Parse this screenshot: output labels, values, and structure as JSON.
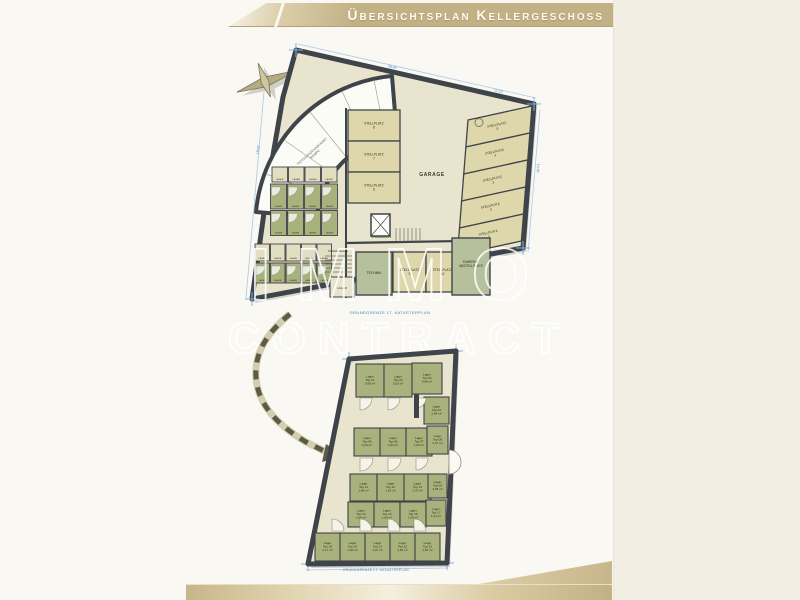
{
  "page": {
    "title": "Übersichtsplan Kellergeschoss",
    "watermark_top": "IMMO",
    "watermark_bottom": "CONTRACT"
  },
  "colors": {
    "banner_gold": "#c2b185",
    "footer_gold": "#c7b68a",
    "wall": "#3f444b",
    "plan_fill": "#e9e4cd",
    "room_green": "#a9b17c",
    "tech_green": "#b7c09c",
    "parking_fill": "#ddd7ab",
    "road_white": "#fcfcf6",
    "dimension_blue": "#3f86c2",
    "label_dark": "#2e3118"
  },
  "big_plan": {
    "garage": "GARAGE",
    "ramp_line1": "TIEFGARAGENABFAHRT",
    "ramp_line2": "RAMPE",
    "stairs1": "STIEGENHAUS",
    "stairs2": "STIEGENHAUS",
    "technik": "TECHNIK",
    "bike_line1": "FAHRRAD",
    "bike_line2": "ABSTELLPLATZ",
    "cellar_room": "LAGER",
    "parking_label": "STELLPLATZ",
    "parking_left": [
      {
        "x": 348,
        "y": 110,
        "w": 52,
        "h": 31,
        "num": "8"
      },
      {
        "x": 348,
        "y": 141,
        "w": 52,
        "h": 31,
        "num": "7"
      },
      {
        "x": 348,
        "y": 172,
        "w": 52,
        "h": 31,
        "num": "6"
      }
    ],
    "parking_right": [
      {
        "num": "5",
        "accessible": true
      },
      {
        "num": "4"
      },
      {
        "num": "3"
      },
      {
        "num": "2"
      },
      {
        "num": "1"
      }
    ],
    "parking_bottom": [
      {
        "x": 393,
        "y": 252,
        "w": 33,
        "h": 40,
        "num": "9"
      },
      {
        "x": 426,
        "y": 252,
        "w": 33,
        "h": 40,
        "num": "10"
      }
    ],
    "cluster_label": "LAGER",
    "cluster_cells": [
      {
        "x": 272,
        "y": 167,
        "w": 15.5,
        "h": 15,
        "f": "c"
      },
      {
        "x": 288.5,
        "y": 167,
        "w": 15.5,
        "h": 15,
        "f": "c"
      },
      {
        "x": 305,
        "y": 167,
        "w": 15.5,
        "h": 15,
        "f": "c"
      },
      {
        "x": 321.5,
        "y": 167,
        "w": 15.5,
        "h": 15,
        "f": "c"
      },
      {
        "x": 270.5,
        "y": 184,
        "w": 16,
        "h": 25,
        "f": "g"
      },
      {
        "x": 287.5,
        "y": 184,
        "w": 16,
        "h": 25,
        "f": "g"
      },
      {
        "x": 304.5,
        "y": 184,
        "w": 16,
        "h": 25,
        "f": "g"
      },
      {
        "x": 321.5,
        "y": 184,
        "w": 16,
        "h": 25,
        "f": "g"
      },
      {
        "x": 270.5,
        "y": 210.5,
        "w": 16,
        "h": 25,
        "f": "g"
      },
      {
        "x": 287.5,
        "y": 210.5,
        "w": 16,
        "h": 25,
        "f": "g"
      },
      {
        "x": 304.5,
        "y": 210.5,
        "w": 16,
        "h": 25,
        "f": "g"
      },
      {
        "x": 321.5,
        "y": 210.5,
        "w": 16,
        "h": 25,
        "f": "g"
      },
      {
        "x": 255,
        "y": 244,
        "w": 14.5,
        "h": 17,
        "f": "c"
      },
      {
        "x": 270.5,
        "y": 244,
        "w": 14.5,
        "h": 17,
        "f": "c"
      },
      {
        "x": 286,
        "y": 244,
        "w": 14.5,
        "h": 17,
        "f": "c"
      },
      {
        "x": 301.5,
        "y": 244,
        "w": 14.5,
        "h": 17,
        "f": "c"
      },
      {
        "x": 317,
        "y": 244,
        "w": 14.5,
        "h": 17,
        "f": "c"
      },
      {
        "x": 255,
        "y": 263,
        "w": 14.5,
        "h": 20,
        "f": "g"
      },
      {
        "x": 270.5,
        "y": 263,
        "w": 14.5,
        "h": 20,
        "f": "g"
      },
      {
        "x": 286,
        "y": 263,
        "w": 14.5,
        "h": 20,
        "f": "g"
      },
      {
        "x": 301.5,
        "y": 263,
        "w": 14.5,
        "h": 20,
        "f": "g"
      },
      {
        "x": 317,
        "y": 263,
        "w": 14.5,
        "h": 20,
        "f": "g"
      }
    ],
    "boundary_text": "GRUNDGRENZE LT. KATASTERPLAN",
    "dim_top_a": "28,45",
    "dim_top_b": "12,10",
    "dim_right": "14,30",
    "dim_left": "19,62"
  },
  "small_plan": {
    "room_label": "Lager",
    "rooms": [
      {
        "x": 356,
        "y": 364,
        "w": 28,
        "h": 33,
        "top": "Top 01",
        "area": "3,99 m²"
      },
      {
        "x": 384,
        "y": 364,
        "w": 28,
        "h": 33,
        "top": "Top 02",
        "area": "3,53 m²"
      },
      {
        "x": 412,
        "y": 363,
        "w": 30,
        "h": 31,
        "top": "Top 03",
        "area": "3,99 m²"
      },
      {
        "x": 424,
        "y": 397,
        "w": 25,
        "h": 27,
        "top": "Top 04",
        "area": "2,64 m²"
      },
      {
        "x": 354,
        "y": 428,
        "w": 26,
        "h": 28,
        "top": "Top 05",
        "area": "1,64 m²"
      },
      {
        "x": 380,
        "y": 428,
        "w": 26,
        "h": 28,
        "top": "Top 06",
        "area": "1,64 m²"
      },
      {
        "x": 406,
        "y": 428,
        "w": 26,
        "h": 28,
        "top": "Top 07",
        "area": "1,64 m²"
      },
      {
        "x": 427,
        "y": 426,
        "w": 21,
        "h": 28,
        "top": "Top 08",
        "area": "2,37 m²"
      },
      {
        "x": 350,
        "y": 474,
        "w": 27,
        "h": 27,
        "top": "Top 11",
        "area": "1,69 m²"
      },
      {
        "x": 377,
        "y": 474,
        "w": 27,
        "h": 27,
        "top": "Top 12",
        "area": "1,62 m²"
      },
      {
        "x": 404,
        "y": 474,
        "w": 27,
        "h": 27,
        "top": "Top 13",
        "area": "1,70 m²"
      },
      {
        "x": 428,
        "y": 474,
        "w": 19,
        "h": 24,
        "top": "Top 09",
        "area": "1,95 m²"
      },
      {
        "x": 348,
        "y": 502,
        "w": 26,
        "h": 25,
        "top": "Top 14",
        "area": "1,66 m²"
      },
      {
        "x": 374,
        "y": 502,
        "w": 26,
        "h": 25,
        "top": "Top 15",
        "area": "1,60 m²"
      },
      {
        "x": 400,
        "y": 502,
        "w": 26,
        "h": 25,
        "top": "Top 16",
        "area": "1,63 m²"
      },
      {
        "x": 426,
        "y": 500,
        "w": 20,
        "h": 26,
        "top": "Top 17",
        "area": "1,44 m²"
      },
      {
        "x": 315,
        "y": 533,
        "w": 25,
        "h": 28,
        "top": "Top 19",
        "area": "2,17 m²"
      },
      {
        "x": 340,
        "y": 533,
        "w": 25,
        "h": 28,
        "top": "Top 20",
        "area": "1,96 m²"
      },
      {
        "x": 365,
        "y": 533,
        "w": 25,
        "h": 28,
        "top": "Top 21",
        "area": "1,37 m²"
      },
      {
        "x": 390,
        "y": 533,
        "w": 25,
        "h": 28,
        "top": "Top 22",
        "area": "1,81 m²"
      },
      {
        "x": 415,
        "y": 533,
        "w": 25,
        "h": 28,
        "top": "Top 23",
        "area": "1,82 m²"
      }
    ],
    "boundary_text": "GRUNDGRENZE LT. KATASTERPLAN"
  }
}
